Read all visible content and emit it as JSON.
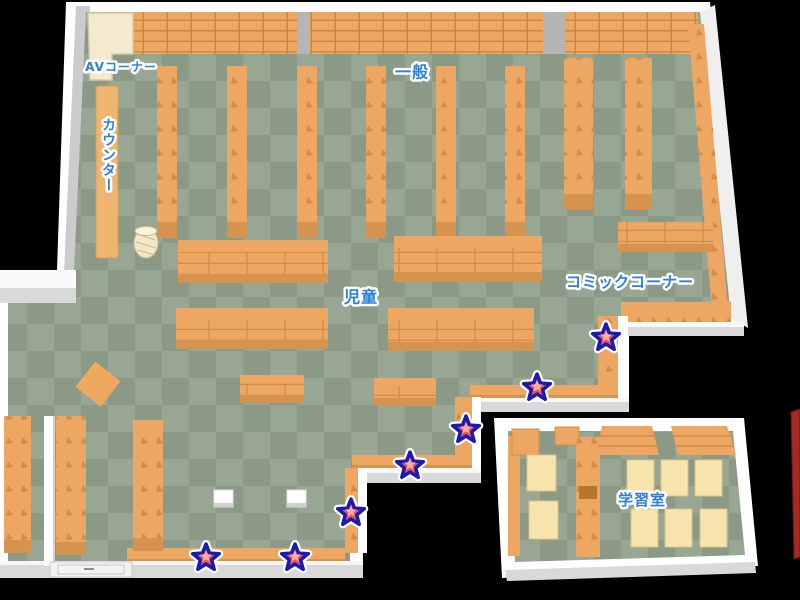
{
  "map": {
    "kind": "library-floor-map",
    "labels": [
      {
        "id": "av-corner",
        "text": "AVコーナー",
        "x": 121,
        "y": 67,
        "size": 12,
        "vertical": false
      },
      {
        "id": "counter",
        "text": "カウンター",
        "x": 108,
        "y": 155,
        "size": 14,
        "vertical": true
      },
      {
        "id": "general",
        "text": "一般",
        "x": 412,
        "y": 72,
        "size": 16,
        "vertical": false
      },
      {
        "id": "children",
        "text": "児童",
        "x": 361,
        "y": 297,
        "size": 16,
        "vertical": false
      },
      {
        "id": "comic-corner",
        "text": "コミックコーナー",
        "x": 630,
        "y": 282,
        "size": 15,
        "vertical": false
      },
      {
        "id": "study-room",
        "text": "学習室",
        "x": 642,
        "y": 500,
        "size": 15,
        "vertical": false
      }
    ],
    "markers": [
      {
        "id": "star-1",
        "x": 606,
        "y": 338
      },
      {
        "id": "star-2",
        "x": 537,
        "y": 388
      },
      {
        "id": "star-3",
        "x": 466,
        "y": 430
      },
      {
        "id": "star-4",
        "x": 410,
        "y": 466
      },
      {
        "id": "star-5",
        "x": 351,
        "y": 513
      },
      {
        "id": "star-6",
        "x": 295,
        "y": 558
      },
      {
        "id": "star-7",
        "x": 206,
        "y": 558
      }
    ],
    "colors": {
      "label_text": "#2e7fd8",
      "label_outline": "#ffffff",
      "marker_fill": "#f2554e",
      "marker_highlight": "#ffada8",
      "marker_outline": "#1a1ab4",
      "floor_light": "#98a694",
      "floor_dark": "#8b9a87",
      "shelf_orange": "#eda763",
      "shelf_face": "#d59350",
      "wall_white": "#ffffff",
      "desk_cream": "#f7e4ad",
      "av_cream": "#f4ead0",
      "background": "#000000"
    }
  }
}
